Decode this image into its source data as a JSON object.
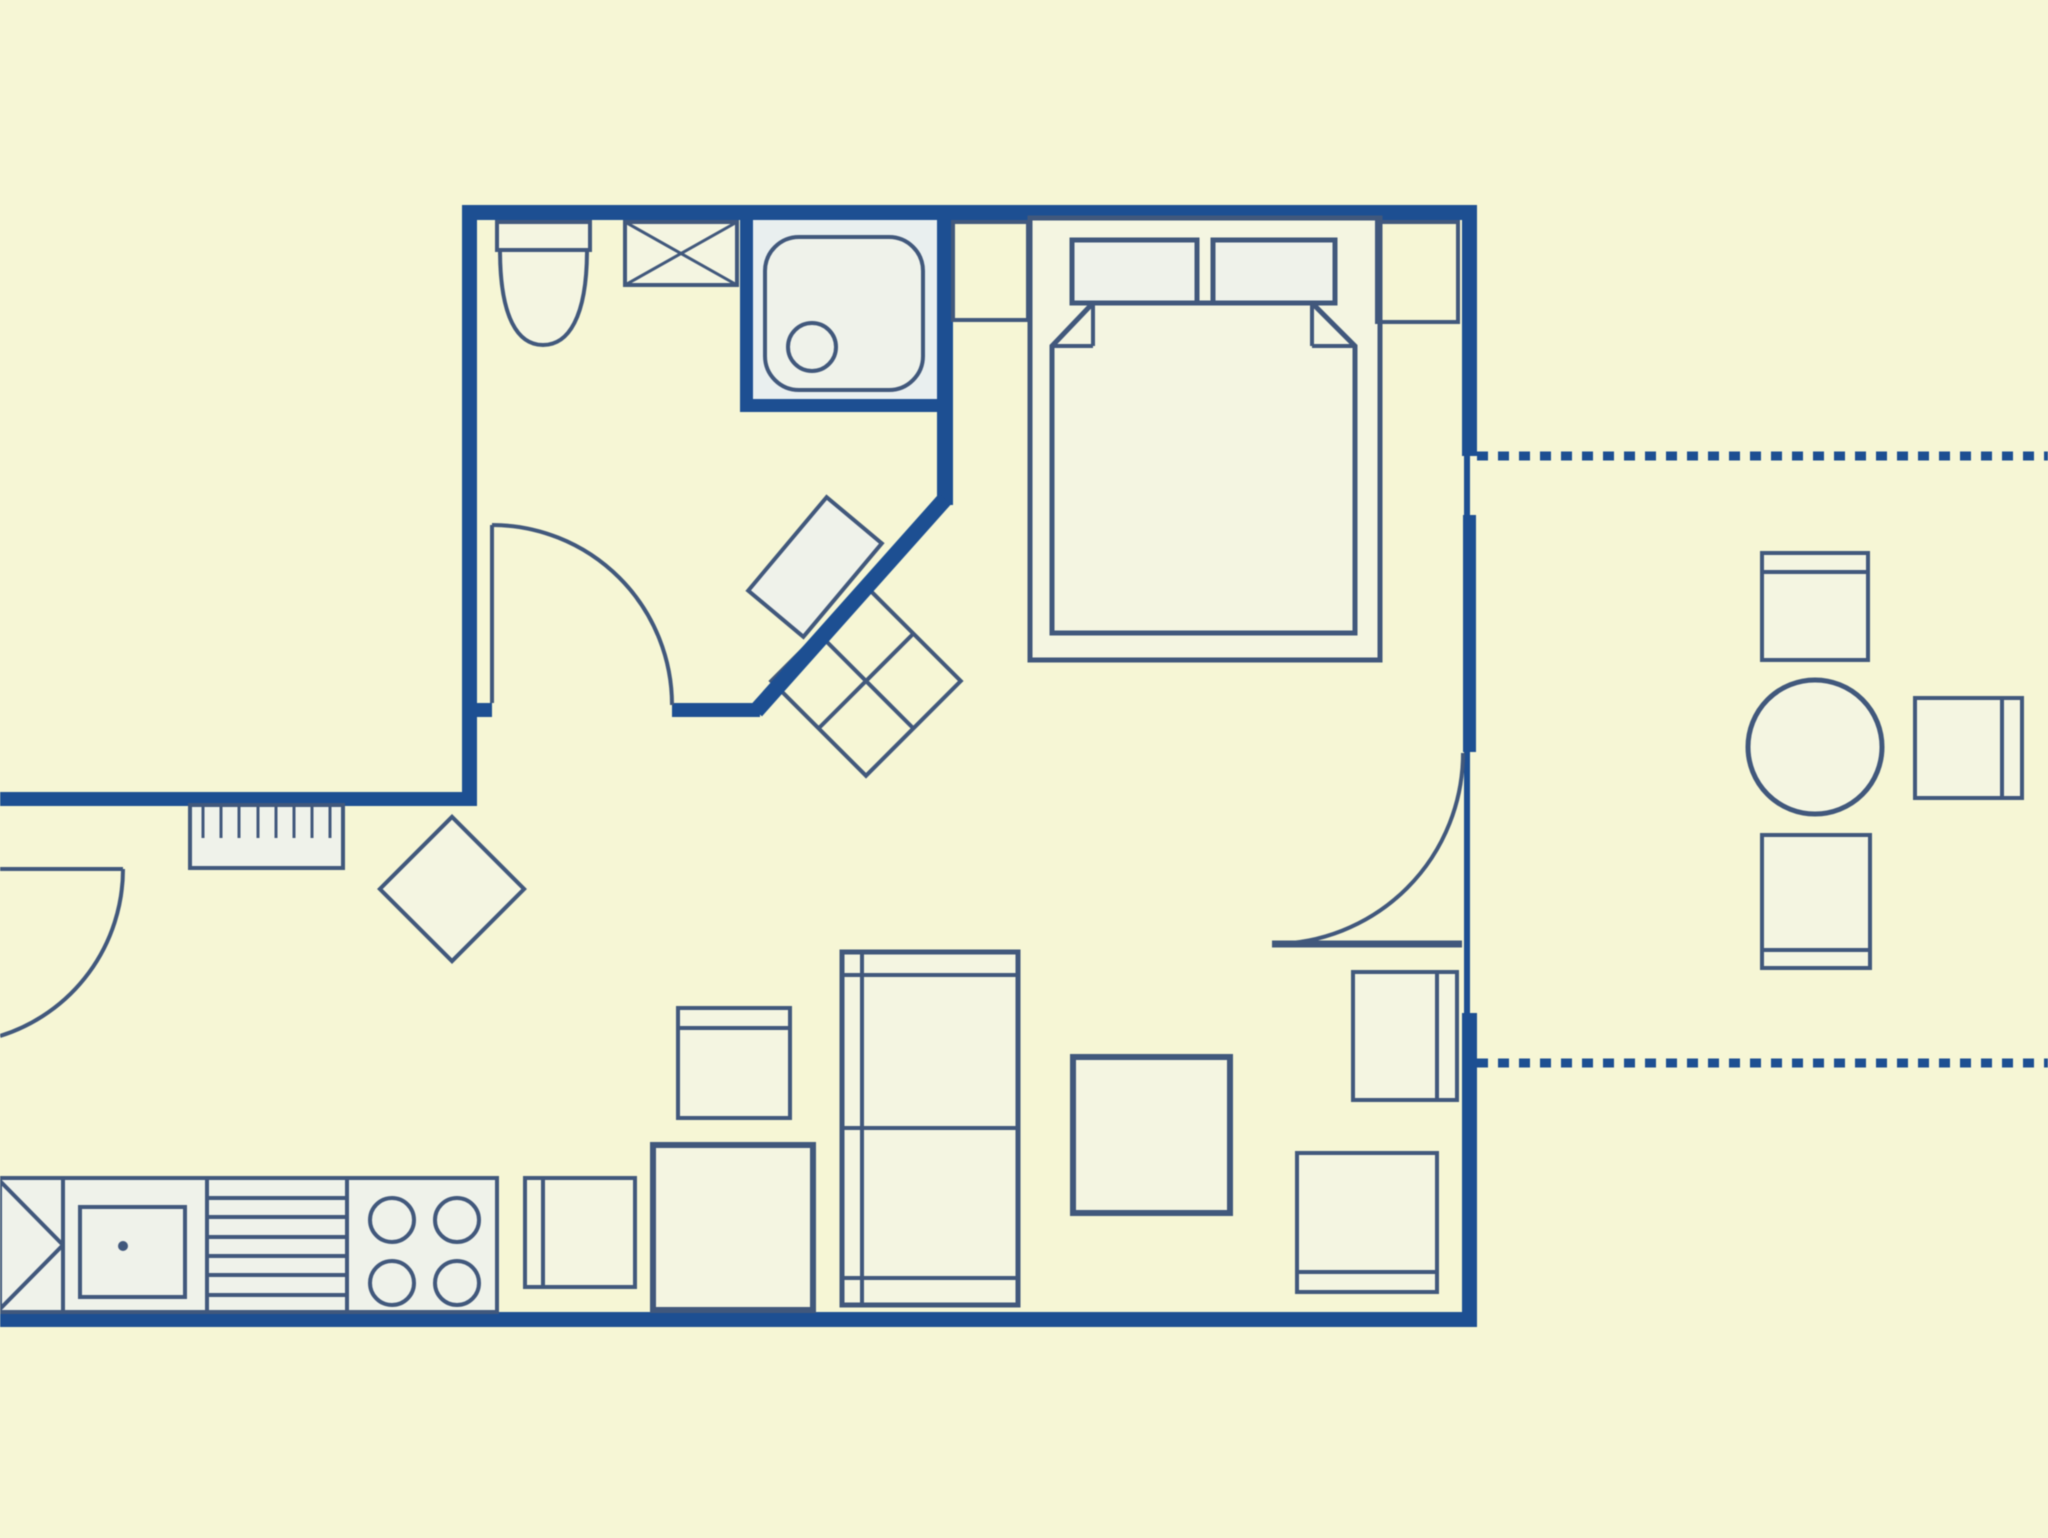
{
  "figure": {
    "type": "floor_plan",
    "label": "apartment-floor-plan-with-terrace"
  },
  "canvas": {
    "width": 2048,
    "height": 1538
  },
  "palette": {
    "background": "#f6f6d5",
    "wall": "#1d4f92",
    "furniture": "#41587c",
    "paleCream": "#f4f5e1",
    "paleWhite": "#eff2ea",
    "paleBlue": "#e9efef"
  },
  "shapes": [
    {
      "name": "shower-area-fill",
      "type": "rect",
      "x": 753,
      "y": 220,
      "w": 184,
      "h": 179,
      "fill": "paleBlue"
    },
    {
      "name": "counter-fill",
      "type": "rect",
      "x": 0,
      "y": 1178,
      "w": 497,
      "h": 134,
      "fill": "paleWhite"
    },
    {
      "name": "washbasin",
      "type": "rect",
      "x": -36,
      "y": -61,
      "w": 72,
      "h": 122,
      "stroke": "furniture",
      "sw": 4,
      "fill": "paleWhite",
      "transform": "translate(815,567) rotate(40)"
    },
    {
      "name": "hall-cabinet",
      "type": "rect",
      "x": -67,
      "y": -67,
      "w": 134,
      "h": 134,
      "stroke": "furniture",
      "sw": 4,
      "fill": "none",
      "transform": "translate(866,681) rotate(45)"
    },
    {
      "name": "hall-cabinet-cross-1",
      "type": "line",
      "x1": -67,
      "y1": 0,
      "x2": 67,
      "y2": 0,
      "stroke": "furniture",
      "sw": 4,
      "transform": "translate(866,681) rotate(45)"
    },
    {
      "name": "hall-cabinet-cross-2",
      "type": "line",
      "x1": 0,
      "y1": -67,
      "x2": 0,
      "y2": 67,
      "stroke": "furniture",
      "sw": 4,
      "transform": "translate(866,681) rotate(45)"
    },
    {
      "name": "stool",
      "type": "rect",
      "x": -51,
      "y": -51,
      "w": 102,
      "h": 102,
      "stroke": "furniture",
      "sw": 4,
      "fill": "paleCream",
      "transform": "translate(452,889) rotate(45)"
    },
    {
      "name": "top-wall",
      "type": "rect",
      "x": 462,
      "y": 205,
      "w": 1015,
      "h": 15,
      "fill": "wall"
    },
    {
      "name": "bathroom-left-wall",
      "type": "rect",
      "x": 462,
      "y": 205,
      "w": 15,
      "h": 600,
      "fill": "wall"
    },
    {
      "name": "hall-wall",
      "type": "rect",
      "x": 0,
      "y": 792,
      "w": 477,
      "h": 14,
      "fill": "wall"
    },
    {
      "name": "bottom-wall",
      "type": "rect",
      "x": 0,
      "y": 1312,
      "w": 1477,
      "h": 15,
      "fill": "wall"
    },
    {
      "name": "right-wall-top",
      "type": "rect",
      "x": 1462,
      "y": 205,
      "w": 15,
      "h": 251,
      "fill": "wall"
    },
    {
      "name": "right-wall-window-sill",
      "type": "rect",
      "x": 1464,
      "y": 455,
      "w": 6,
      "h": 62,
      "fill": "wall"
    },
    {
      "name": "right-wall-mid",
      "type": "rect",
      "x": 1463,
      "y": 515,
      "w": 13,
      "h": 237,
      "fill": "wall"
    },
    {
      "name": "right-wall-door-threshold",
      "type": "rect",
      "x": 1464,
      "y": 752,
      "w": 6,
      "h": 261,
      "fill": "wall"
    },
    {
      "name": "right-wall-bottom",
      "type": "rect",
      "x": 1462,
      "y": 1013,
      "w": 15,
      "h": 314,
      "fill": "wall"
    },
    {
      "name": "bathroom-right-wall",
      "type": "rect",
      "x": 937,
      "y": 205,
      "w": 16,
      "h": 300,
      "fill": "wall"
    },
    {
      "name": "diagonal-wall",
      "type": "line",
      "x1": 945,
      "y1": 499,
      "x2": 756,
      "y2": 711,
      "stroke": "wall",
      "sw": 16
    },
    {
      "name": "bathroom-bottom-wall-left",
      "type": "rect",
      "x": 462,
      "y": 703,
      "w": 30,
      "h": 14,
      "fill": "wall"
    },
    {
      "name": "bathroom-bottom-wall-right",
      "type": "rect",
      "x": 672,
      "y": 703,
      "w": 88,
      "h": 14,
      "fill": "wall"
    },
    {
      "name": "shower-wall-vertical",
      "type": "rect",
      "x": 740,
      "y": 220,
      "w": 13,
      "h": 192,
      "fill": "wall"
    },
    {
      "name": "shower-wall-horizontal",
      "type": "rect",
      "x": 740,
      "y": 399,
      "w": 213,
      "h": 13,
      "fill": "wall"
    },
    {
      "name": "bathroom-door-leaf",
      "type": "line",
      "x1": 492,
      "y1": 525,
      "x2": 492,
      "y2": 703,
      "stroke": "furniture",
      "sw": 4
    },
    {
      "name": "bathroom-door-arc",
      "type": "path",
      "d": "M492,525 A180,180 0 0 1 672,705",
      "stroke": "furniture",
      "sw": 4,
      "fill": "none"
    },
    {
      "name": "entry-door-leaf",
      "type": "line",
      "x1": 0,
      "y1": 869,
      "x2": 123,
      "y2": 869,
      "stroke": "furniture",
      "sw": 4
    },
    {
      "name": "entry-door-arc",
      "type": "path",
      "d": "M123,869 A175,175 0 0 1 0,1036",
      "stroke": "furniture",
      "sw": 4,
      "fill": "none"
    },
    {
      "name": "bedroom-door-leaf",
      "type": "line",
      "x1": 1272,
      "y1": 944,
      "x2": 1462,
      "y2": 944,
      "stroke": "furniture",
      "sw": 7
    },
    {
      "name": "bedroom-door-arc",
      "type": "path",
      "d": "M1272,944 A191,191 0 0 0 1463,753",
      "stroke": "furniture",
      "sw": 4,
      "fill": "none"
    },
    {
      "name": "terrace-boundary-dash-upper",
      "type": "line",
      "x1": 1477,
      "y1": 456,
      "x2": 2048,
      "y2": 456,
      "stroke": "wall",
      "sw": 9,
      "dash": "11 10"
    },
    {
      "name": "terrace-boundary-dash-lower",
      "type": "line",
      "x1": 1477,
      "y1": 1063,
      "x2": 2048,
      "y2": 1063,
      "stroke": "wall",
      "sw": 9,
      "dash": "11 10"
    },
    {
      "name": "toilet-cistern",
      "type": "rect",
      "x": 497,
      "y": 222,
      "w": 93,
      "h": 28,
      "stroke": "furniture",
      "sw": 4,
      "fill": "paleCream"
    },
    {
      "name": "toilet-bowl",
      "type": "path",
      "d": "M500,250 C500,318 518,345 543,345 C568,345 587,318 587,250 Z",
      "stroke": "furniture",
      "sw": 4,
      "fill": "paleCream"
    },
    {
      "name": "washing-machine",
      "type": "rect",
      "x": 625,
      "y": 222,
      "w": 112,
      "h": 63,
      "stroke": "furniture",
      "sw": 4,
      "fill": "paleCream"
    },
    {
      "name": "washing-machine-x-1",
      "type": "line",
      "x1": 625,
      "y1": 222,
      "x2": 737,
      "y2": 285,
      "stroke": "furniture",
      "sw": 3
    },
    {
      "name": "washing-machine-x-2",
      "type": "line",
      "x1": 625,
      "y1": 285,
      "x2": 737,
      "y2": 222,
      "stroke": "furniture",
      "sw": 3
    },
    {
      "name": "shower-tray",
      "type": "rect",
      "x": 765,
      "y": 237,
      "w": 158,
      "h": 153,
      "rx": 34,
      "stroke": "furniture",
      "sw": 4,
      "fill": "paleWhite"
    },
    {
      "name": "shower-drain",
      "type": "circle",
      "cx": 812,
      "cy": 347,
      "r": 24,
      "stroke": "furniture",
      "sw": 4,
      "fill": "none"
    },
    {
      "name": "radiator",
      "type": "rect",
      "x": 190,
      "y": 805,
      "w": 153,
      "h": 63,
      "stroke": "furniture",
      "sw": 4,
      "fill": "paleWhite"
    },
    {
      "name": "radiator-fin-1",
      "type": "line",
      "x1": 203,
      "y1": 805,
      "x2": 203,
      "y2": 838,
      "stroke": "furniture",
      "sw": 3
    },
    {
      "name": "radiator-fin-2",
      "type": "line",
      "x1": 221,
      "y1": 805,
      "x2": 221,
      "y2": 838,
      "stroke": "furniture",
      "sw": 3
    },
    {
      "name": "radiator-fin-3",
      "type": "line",
      "x1": 239,
      "y1": 805,
      "x2": 239,
      "y2": 838,
      "stroke": "furniture",
      "sw": 3
    },
    {
      "name": "radiator-fin-4",
      "type": "line",
      "x1": 258,
      "y1": 805,
      "x2": 258,
      "y2": 838,
      "stroke": "furniture",
      "sw": 3
    },
    {
      "name": "radiator-fin-5",
      "type": "line",
      "x1": 276,
      "y1": 805,
      "x2": 276,
      "y2": 838,
      "stroke": "furniture",
      "sw": 3
    },
    {
      "name": "radiator-fin-6",
      "type": "line",
      "x1": 294,
      "y1": 805,
      "x2": 294,
      "y2": 838,
      "stroke": "furniture",
      "sw": 3
    },
    {
      "name": "radiator-fin-7",
      "type": "line",
      "x1": 312,
      "y1": 805,
      "x2": 312,
      "y2": 838,
      "stroke": "furniture",
      "sw": 3
    },
    {
      "name": "radiator-fin-8",
      "type": "line",
      "x1": 330,
      "y1": 805,
      "x2": 330,
      "y2": 838,
      "stroke": "furniture",
      "sw": 3
    },
    {
      "name": "kitchen-counter-outline",
      "type": "rect",
      "x": 0,
      "y": 1178,
      "w": 497,
      "h": 134,
      "stroke": "furniture",
      "sw": 4,
      "fill": "none"
    },
    {
      "name": "counter-divider-1",
      "type": "line",
      "x1": 63,
      "y1": 1178,
      "x2": 63,
      "y2": 1312,
      "stroke": "furniture",
      "sw": 4
    },
    {
      "name": "counter-divider-2",
      "type": "line",
      "x1": 207,
      "y1": 1178,
      "x2": 207,
      "y2": 1312,
      "stroke": "furniture",
      "sw": 4
    },
    {
      "name": "counter-divider-3",
      "type": "line",
      "x1": 347,
      "y1": 1178,
      "x2": 347,
      "y2": 1312,
      "stroke": "furniture",
      "sw": 4
    },
    {
      "name": "corner-unit-diagonal-1",
      "type": "line",
      "x1": 0,
      "y1": 1181,
      "x2": 63,
      "y2": 1245,
      "stroke": "furniture",
      "sw": 4
    },
    {
      "name": "corner-unit-diagonal-2",
      "type": "line",
      "x1": 0,
      "y1": 1309,
      "x2": 63,
      "y2": 1245,
      "stroke": "furniture",
      "sw": 4
    },
    {
      "name": "sink-basin",
      "type": "rect",
      "x": 80,
      "y": 1207,
      "w": 105,
      "h": 90,
      "stroke": "furniture",
      "sw": 4,
      "fill": "none"
    },
    {
      "name": "sink-tap-dot",
      "type": "circle",
      "cx": 123,
      "cy": 1246,
      "r": 5,
      "fill": "furniture"
    },
    {
      "name": "drainer-line-1",
      "type": "line",
      "x1": 207,
      "y1": 1198,
      "x2": 347,
      "y2": 1198,
      "stroke": "furniture",
      "sw": 4
    },
    {
      "name": "drainer-line-2",
      "type": "line",
      "x1": 207,
      "y1": 1217,
      "x2": 347,
      "y2": 1217,
      "stroke": "furniture",
      "sw": 4
    },
    {
      "name": "drainer-line-3",
      "type": "line",
      "x1": 207,
      "y1": 1237,
      "x2": 347,
      "y2": 1237,
      "stroke": "furniture",
      "sw": 4
    },
    {
      "name": "drainer-line-4",
      "type": "line",
      "x1": 207,
      "y1": 1256,
      "x2": 347,
      "y2": 1256,
      "stroke": "furniture",
      "sw": 4
    },
    {
      "name": "drainer-line-5",
      "type": "line",
      "x1": 207,
      "y1": 1275,
      "x2": 347,
      "y2": 1275,
      "stroke": "furniture",
      "sw": 4
    },
    {
      "name": "drainer-line-6",
      "type": "line",
      "x1": 207,
      "y1": 1295,
      "x2": 347,
      "y2": 1295,
      "stroke": "furniture",
      "sw": 4
    },
    {
      "name": "stove-burner-1",
      "type": "circle",
      "cx": 392,
      "cy": 1220,
      "r": 22,
      "stroke": "furniture",
      "sw": 4,
      "fill": "none"
    },
    {
      "name": "stove-burner-2",
      "type": "circle",
      "cx": 457,
      "cy": 1220,
      "r": 22,
      "stroke": "furniture",
      "sw": 4,
      "fill": "none"
    },
    {
      "name": "stove-burner-3",
      "type": "circle",
      "cx": 392,
      "cy": 1283,
      "r": 22,
      "stroke": "furniture",
      "sw": 4,
      "fill": "none"
    },
    {
      "name": "stove-burner-4",
      "type": "circle",
      "cx": 457,
      "cy": 1283,
      "r": 22,
      "stroke": "furniture",
      "sw": 4,
      "fill": "none"
    },
    {
      "name": "kitchen-chair-left",
      "type": "rect",
      "x": 525,
      "y": 1178,
      "w": 110,
      "h": 109,
      "stroke": "furniture",
      "sw": 4,
      "fill": "paleCream"
    },
    {
      "name": "kitchen-chair-left-backrest",
      "type": "line",
      "x1": 543,
      "y1": 1178,
      "x2": 543,
      "y2": 1287,
      "stroke": "furniture",
      "sw": 4
    },
    {
      "name": "kitchen-table",
      "type": "rect",
      "x": 653,
      "y": 1145,
      "w": 160,
      "h": 165,
      "stroke": "furniture",
      "sw": 6,
      "fill": "paleCream"
    },
    {
      "name": "kitchen-chair-top",
      "type": "rect",
      "x": 678,
      "y": 1008,
      "w": 112,
      "h": 110,
      "stroke": "furniture",
      "sw": 4,
      "fill": "paleCream"
    },
    {
      "name": "kitchen-chair-top-backrest",
      "type": "line",
      "x1": 678,
      "y1": 1028,
      "x2": 790,
      "y2": 1028,
      "stroke": "furniture",
      "sw": 4
    },
    {
      "name": "shelf-unit",
      "type": "rect",
      "x": 842,
      "y": 952,
      "w": 176,
      "h": 353,
      "stroke": "furniture",
      "sw": 5,
      "fill": "paleCream"
    },
    {
      "name": "shelf-unit-line-top",
      "type": "line",
      "x1": 842,
      "y1": 975,
      "x2": 1018,
      "y2": 975,
      "stroke": "furniture",
      "sw": 4
    },
    {
      "name": "shelf-unit-line-middle",
      "type": "line",
      "x1": 842,
      "y1": 1128,
      "x2": 1018,
      "y2": 1128,
      "stroke": "furniture",
      "sw": 4
    },
    {
      "name": "shelf-unit-line-bottom",
      "type": "line",
      "x1": 842,
      "y1": 1278,
      "x2": 1018,
      "y2": 1278,
      "stroke": "furniture",
      "sw": 4
    },
    {
      "name": "shelf-unit-line-left",
      "type": "line",
      "x1": 862,
      "y1": 952,
      "x2": 862,
      "y2": 1305,
      "stroke": "furniture",
      "sw": 4
    },
    {
      "name": "living-table",
      "type": "rect",
      "x": 1073,
      "y": 1057,
      "w": 157,
      "h": 156,
      "stroke": "furniture",
      "sw": 6,
      "fill": "paleCream"
    },
    {
      "name": "living-chair-right",
      "type": "rect",
      "x": 1353,
      "y": 972,
      "w": 104,
      "h": 128,
      "stroke": "furniture",
      "sw": 4,
      "fill": "paleCream"
    },
    {
      "name": "living-chair-right-backrest",
      "type": "line",
      "x1": 1437,
      "y1": 972,
      "x2": 1437,
      "y2": 1100,
      "stroke": "furniture",
      "sw": 4
    },
    {
      "name": "living-chair-bottom",
      "type": "rect",
      "x": 1297,
      "y": 1153,
      "w": 140,
      "h": 139,
      "stroke": "furniture",
      "sw": 4,
      "fill": "paleCream"
    },
    {
      "name": "living-chair-bottom-backrest",
      "type": "line",
      "x1": 1297,
      "y1": 1272,
      "x2": 1437,
      "y2": 1272,
      "stroke": "furniture",
      "sw": 4
    },
    {
      "name": "bed-frame",
      "type": "rect",
      "x": 1030,
      "y": 218,
      "w": 350,
      "h": 442,
      "stroke": "furniture",
      "sw": 5,
      "fill": "paleCream"
    },
    {
      "name": "pillow-left",
      "type": "rect",
      "x": 1072,
      "y": 240,
      "w": 125,
      "h": 63,
      "stroke": "furniture",
      "sw": 5,
      "fill": "paleWhite"
    },
    {
      "name": "pillow-right",
      "type": "rect",
      "x": 1213,
      "y": 240,
      "w": 122,
      "h": 63,
      "stroke": "furniture",
      "sw": 5,
      "fill": "paleWhite"
    },
    {
      "name": "duvet",
      "type": "polygon",
      "points": "1093,303 1312,303 1355,346 1355,633 1052,633 1052,346",
      "stroke": "furniture",
      "sw": 5,
      "fill": "paleCream"
    },
    {
      "name": "duvet-fold-left-vertical",
      "type": "line",
      "x1": 1093,
      "y1": 303,
      "x2": 1093,
      "y2": 346,
      "stroke": "furniture",
      "sw": 4
    },
    {
      "name": "duvet-fold-left-horizontal",
      "type": "line",
      "x1": 1052,
      "y1": 346,
      "x2": 1093,
      "y2": 346,
      "stroke": "furniture",
      "sw": 4
    },
    {
      "name": "duvet-fold-right-vertical",
      "type": "line",
      "x1": 1312,
      "y1": 303,
      "x2": 1312,
      "y2": 346,
      "stroke": "furniture",
      "sw": 4
    },
    {
      "name": "duvet-fold-right-horizontal",
      "type": "line",
      "x1": 1312,
      "y1": 346,
      "x2": 1355,
      "y2": 346,
      "stroke": "furniture",
      "sw": 4
    },
    {
      "name": "nightstand-left",
      "type": "rect",
      "x": 953,
      "y": 222,
      "w": 75,
      "h": 98,
      "stroke": "furniture",
      "sw": 4,
      "fill": "none"
    },
    {
      "name": "nightstand-right",
      "type": "rect",
      "x": 1377,
      "y": 222,
      "w": 81,
      "h": 100,
      "stroke": "furniture",
      "sw": 4,
      "fill": "none"
    },
    {
      "name": "terrace-chair-top",
      "type": "rect",
      "x": 1762,
      "y": 553,
      "w": 106,
      "h": 107,
      "stroke": "furniture",
      "sw": 4,
      "fill": "paleCream"
    },
    {
      "name": "terrace-chair-top-backrest",
      "type": "line",
      "x1": 1762,
      "y1": 572,
      "x2": 1868,
      "y2": 572,
      "stroke": "furniture",
      "sw": 4
    },
    {
      "name": "terrace-table",
      "type": "circle",
      "cx": 1815,
      "cy": 747,
      "r": 67,
      "stroke": "furniture",
      "sw": 5,
      "fill": "paleCream"
    },
    {
      "name": "terrace-chair-right",
      "type": "rect",
      "x": 1915,
      "y": 698,
      "w": 107,
      "h": 100,
      "stroke": "furniture",
      "sw": 4,
      "fill": "paleCream"
    },
    {
      "name": "terrace-chair-right-backrest",
      "type": "line",
      "x1": 2002,
      "y1": 698,
      "x2": 2002,
      "y2": 798,
      "stroke": "furniture",
      "sw": 4
    },
    {
      "name": "terrace-chair-bottom",
      "type": "rect",
      "x": 1762,
      "y": 835,
      "w": 108,
      "h": 133,
      "stroke": "furniture",
      "sw": 4,
      "fill": "paleCream"
    },
    {
      "name": "terrace-chair-bottom-backrest",
      "type": "line",
      "x1": 1762,
      "y1": 950,
      "x2": 1870,
      "y2": 950,
      "stroke": "furniture",
      "sw": 4
    }
  ]
}
